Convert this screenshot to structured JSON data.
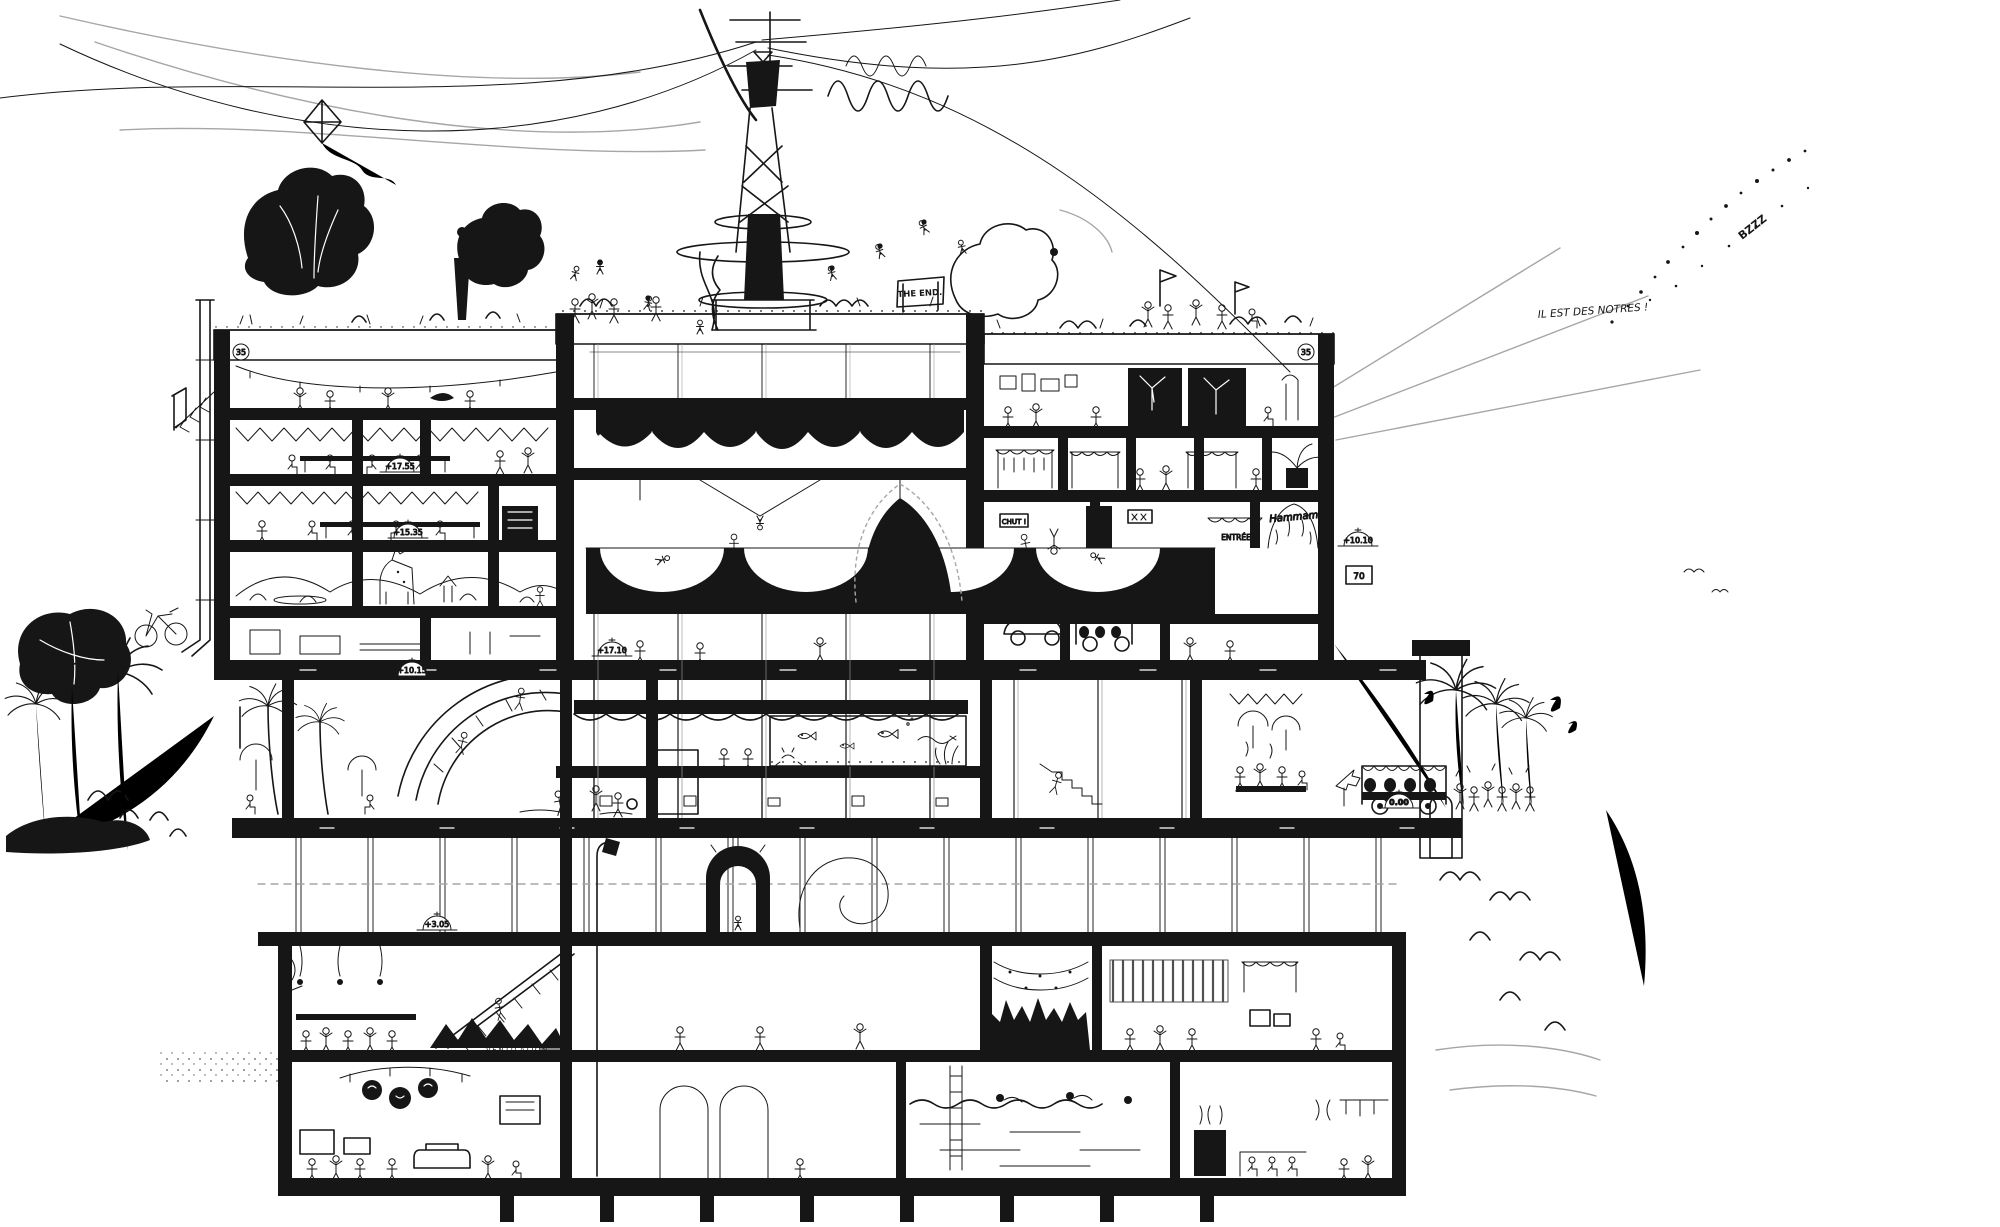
{
  "colors": {
    "ink": "#161616",
    "paper": "#ffffff",
    "pencil": "#a6a6a6"
  },
  "labels": {
    "the_end": "THE END.",
    "il_est_des_notres": "IL EST DES NOTRES !",
    "bzzz": "BZZZ",
    "hammam": "Hammam",
    "chut": "CHUT !",
    "entree": "ENTRÉE",
    "stall_number": "70",
    "ventilation": "VENTILATION",
    "caisson_lumineux_left": "CAISSON LUMINEUX",
    "caisson_lumineux_right": "CAISSON LUMINEUX"
  },
  "elevation_markers": {
    "parapet_left": "35",
    "parapet_right": "35",
    "left_upper": "+17.55",
    "left_mid": "+15.35",
    "center_hall": "+17.10",
    "left_lower": "+10.15",
    "right_mid": "+10.10",
    "left_basement": "+3.05",
    "ground_right": "0.00"
  }
}
